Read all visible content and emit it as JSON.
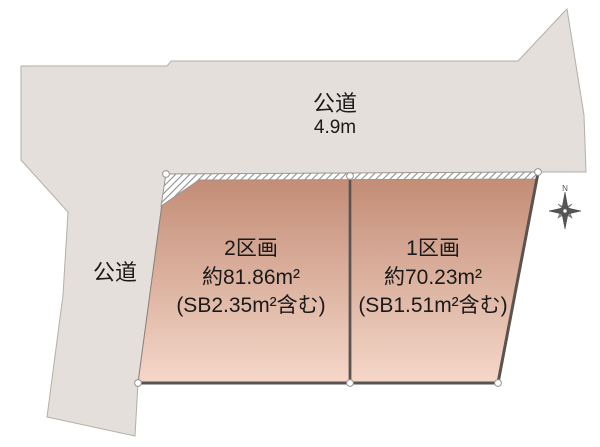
{
  "roads": {
    "top": {
      "name": "公道",
      "width": "4.9m"
    },
    "left": {
      "name": "公道"
    }
  },
  "parcels": [
    {
      "id": "2区画",
      "area": "約81.86m²",
      "area_note": "(SB2.35m²含む)"
    },
    {
      "id": "1区画",
      "area": "約70.23m²",
      "area_note": "(SB1.51m²含む)"
    }
  ],
  "compass": {
    "north": "N"
  },
  "colors": {
    "background": "#ffffff",
    "road_fill": "#e4dfda",
    "road_stroke": "#b6aea7",
    "parcel_gradient_top": "#c18a73",
    "parcel_gradient_bottom": "#f5d7c9",
    "parcel_border": "#5b534f",
    "hatch_stroke": "#8f8f8f",
    "text": "#1a1a1a"
  }
}
